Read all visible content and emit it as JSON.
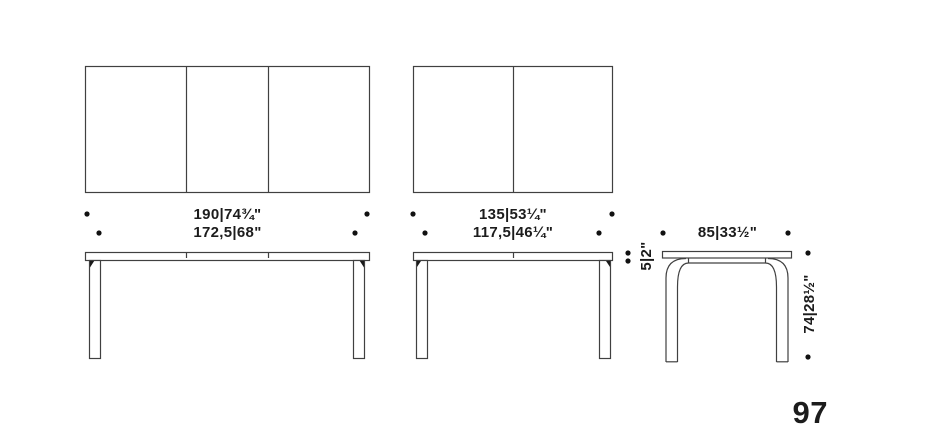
{
  "page": {
    "number": "97"
  },
  "colors": {
    "background": "#ffffff",
    "line": "#404040",
    "text": "#1c1c1c",
    "dot": "#111111"
  },
  "tables": {
    "extendable_large": {
      "description": "three-leaf table, top view and front elevation",
      "width_extended_cm_in": "190|74¾\"",
      "width_closed_cm_in": "172,5|68\""
    },
    "extendable_medium": {
      "description": "two-leaf table, top view and front elevation",
      "width_extended_cm_in": "135|53¼\"",
      "width_closed_cm_in": "117,5|46¼\""
    },
    "side_profile": {
      "description": "table side elevation with bent legs",
      "depth_cm_in": "85|33½\"",
      "top_thickness_cm_in": "5|2\"",
      "height_cm_in": "74|28½\""
    }
  }
}
